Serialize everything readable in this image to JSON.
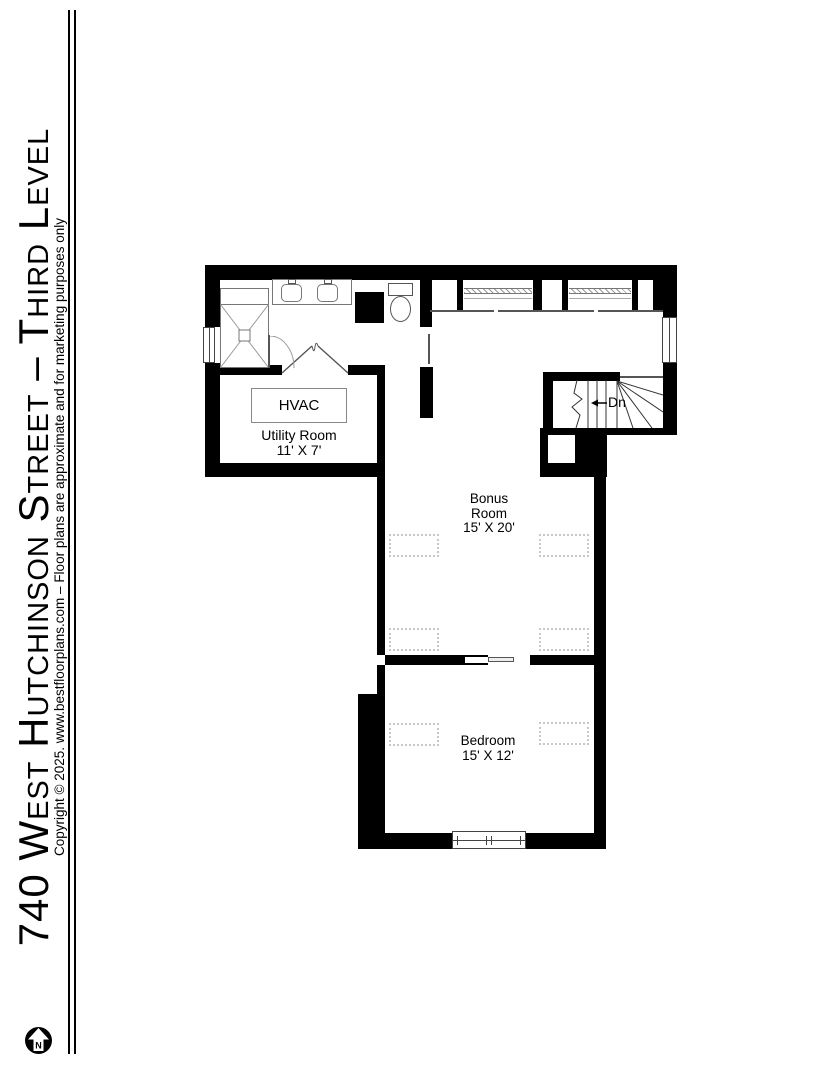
{
  "sidebar": {
    "title": "740 West Hutchinson Street – Third Level",
    "copyright": "Copyright © 2025. www.bestfloorplans.com – Floor plans are approximate and for marketing purposes only",
    "compass": {
      "label": "N"
    }
  },
  "floorplan": {
    "labels": {
      "hvac": "HVAC",
      "stairs": "Dn"
    },
    "rooms": {
      "utility": {
        "name": "Utility Room",
        "dims": "11' X 7'"
      },
      "bonus": {
        "name": "Bonus Room",
        "dims": "15' X 20'"
      },
      "bedroom": {
        "name": "Bedroom",
        "dims": "15' X 12'"
      }
    },
    "colors": {
      "wall": "#000000",
      "fixture": "#777777",
      "dashed_marker": "#c8c8c8"
    }
  }
}
